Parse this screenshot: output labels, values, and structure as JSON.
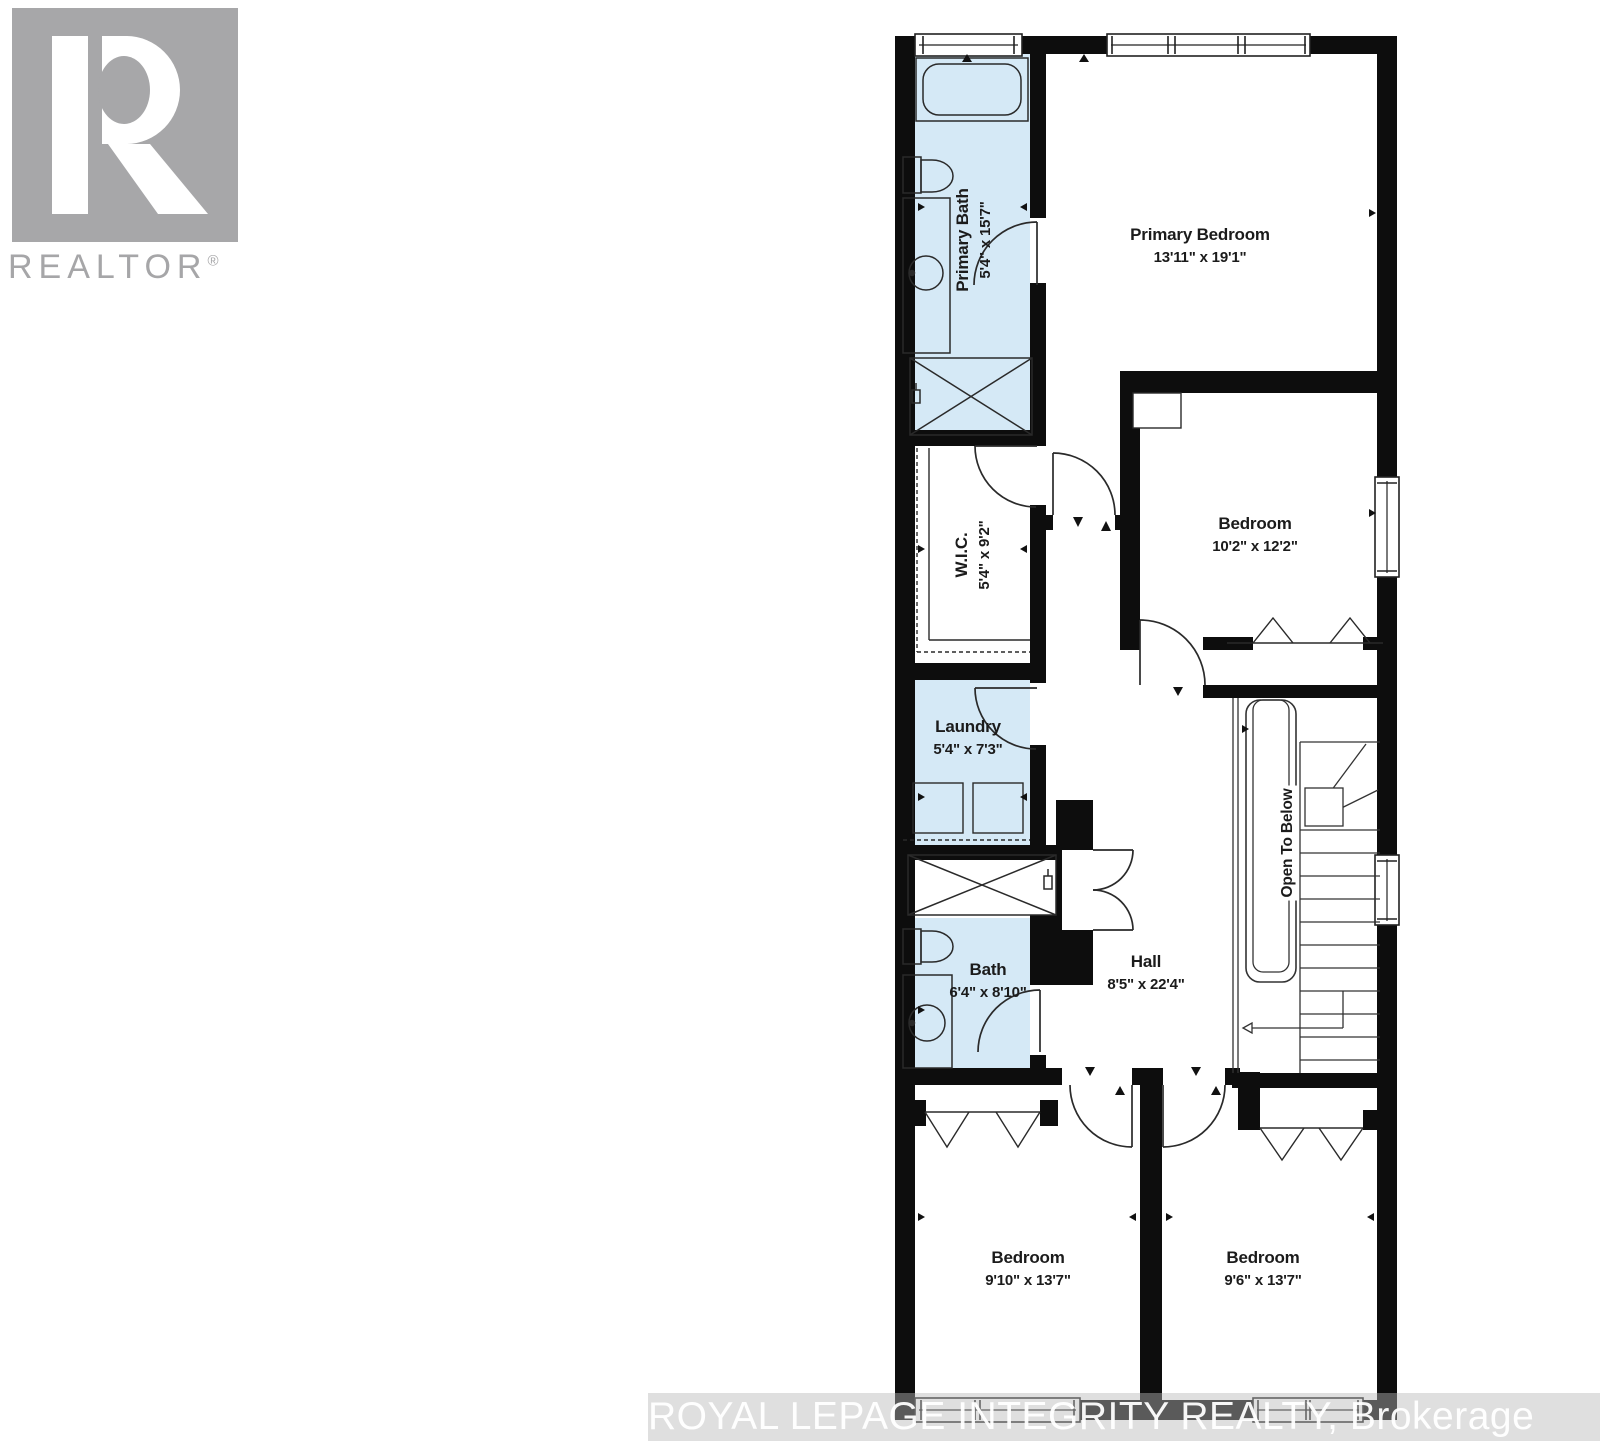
{
  "branding": {
    "logo_text": "REALTOR",
    "registered_mark": "®"
  },
  "watermark": {
    "text": "ROYAL LEPAGE INTEGRITY REALTY, Brokerage"
  },
  "rooms": {
    "primary_bath": {
      "name": "Primary Bath",
      "dims": "5'4\" x 15'7\""
    },
    "primary_bedroom": {
      "name": "Primary Bedroom",
      "dims": "13'11\" x 19'1\""
    },
    "wic": {
      "name": "W.I.C.",
      "dims": "5'4\" x 9'2\""
    },
    "bedroom_upper": {
      "name": "Bedroom",
      "dims": "10'2\" x 12'2\""
    },
    "laundry": {
      "name": "Laundry",
      "dims": "5'4\" x 7'3\""
    },
    "bath": {
      "name": "Bath",
      "dims": "6'4\" x 8'10\""
    },
    "hall": {
      "name": "Hall",
      "dims": "8'5\" x 22'4\""
    },
    "stairs": {
      "name": "Open To Below"
    },
    "bedroom_left": {
      "name": "Bedroom",
      "dims": "9'10\" x 13'7\""
    },
    "bedroom_right": {
      "name": "Bedroom",
      "dims": "9'6\" x 13'7\""
    }
  },
  "colors": {
    "room_fill": "#d5e9f6",
    "wall": "#0d0d0d",
    "logo_gray": "#a7a7a9"
  }
}
